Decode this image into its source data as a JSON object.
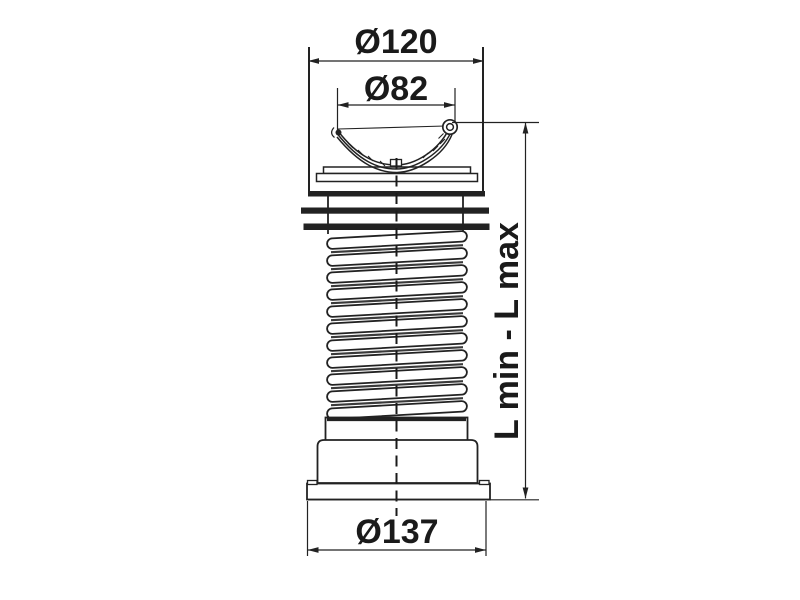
{
  "drawing": {
    "labels": {
      "dia_top_outer": "Ø120",
      "dia_top_inner": "Ø82",
      "dia_bottom": "Ø137",
      "length_range": "L min - L max"
    },
    "dimensions_mm": {
      "top_outer_diameter": 120,
      "top_inner_diameter": 82,
      "bottom_outer_diameter": 137
    },
    "colors": {
      "background": "#ffffff",
      "line": "#222222",
      "text": "#1a1a1a"
    }
  }
}
